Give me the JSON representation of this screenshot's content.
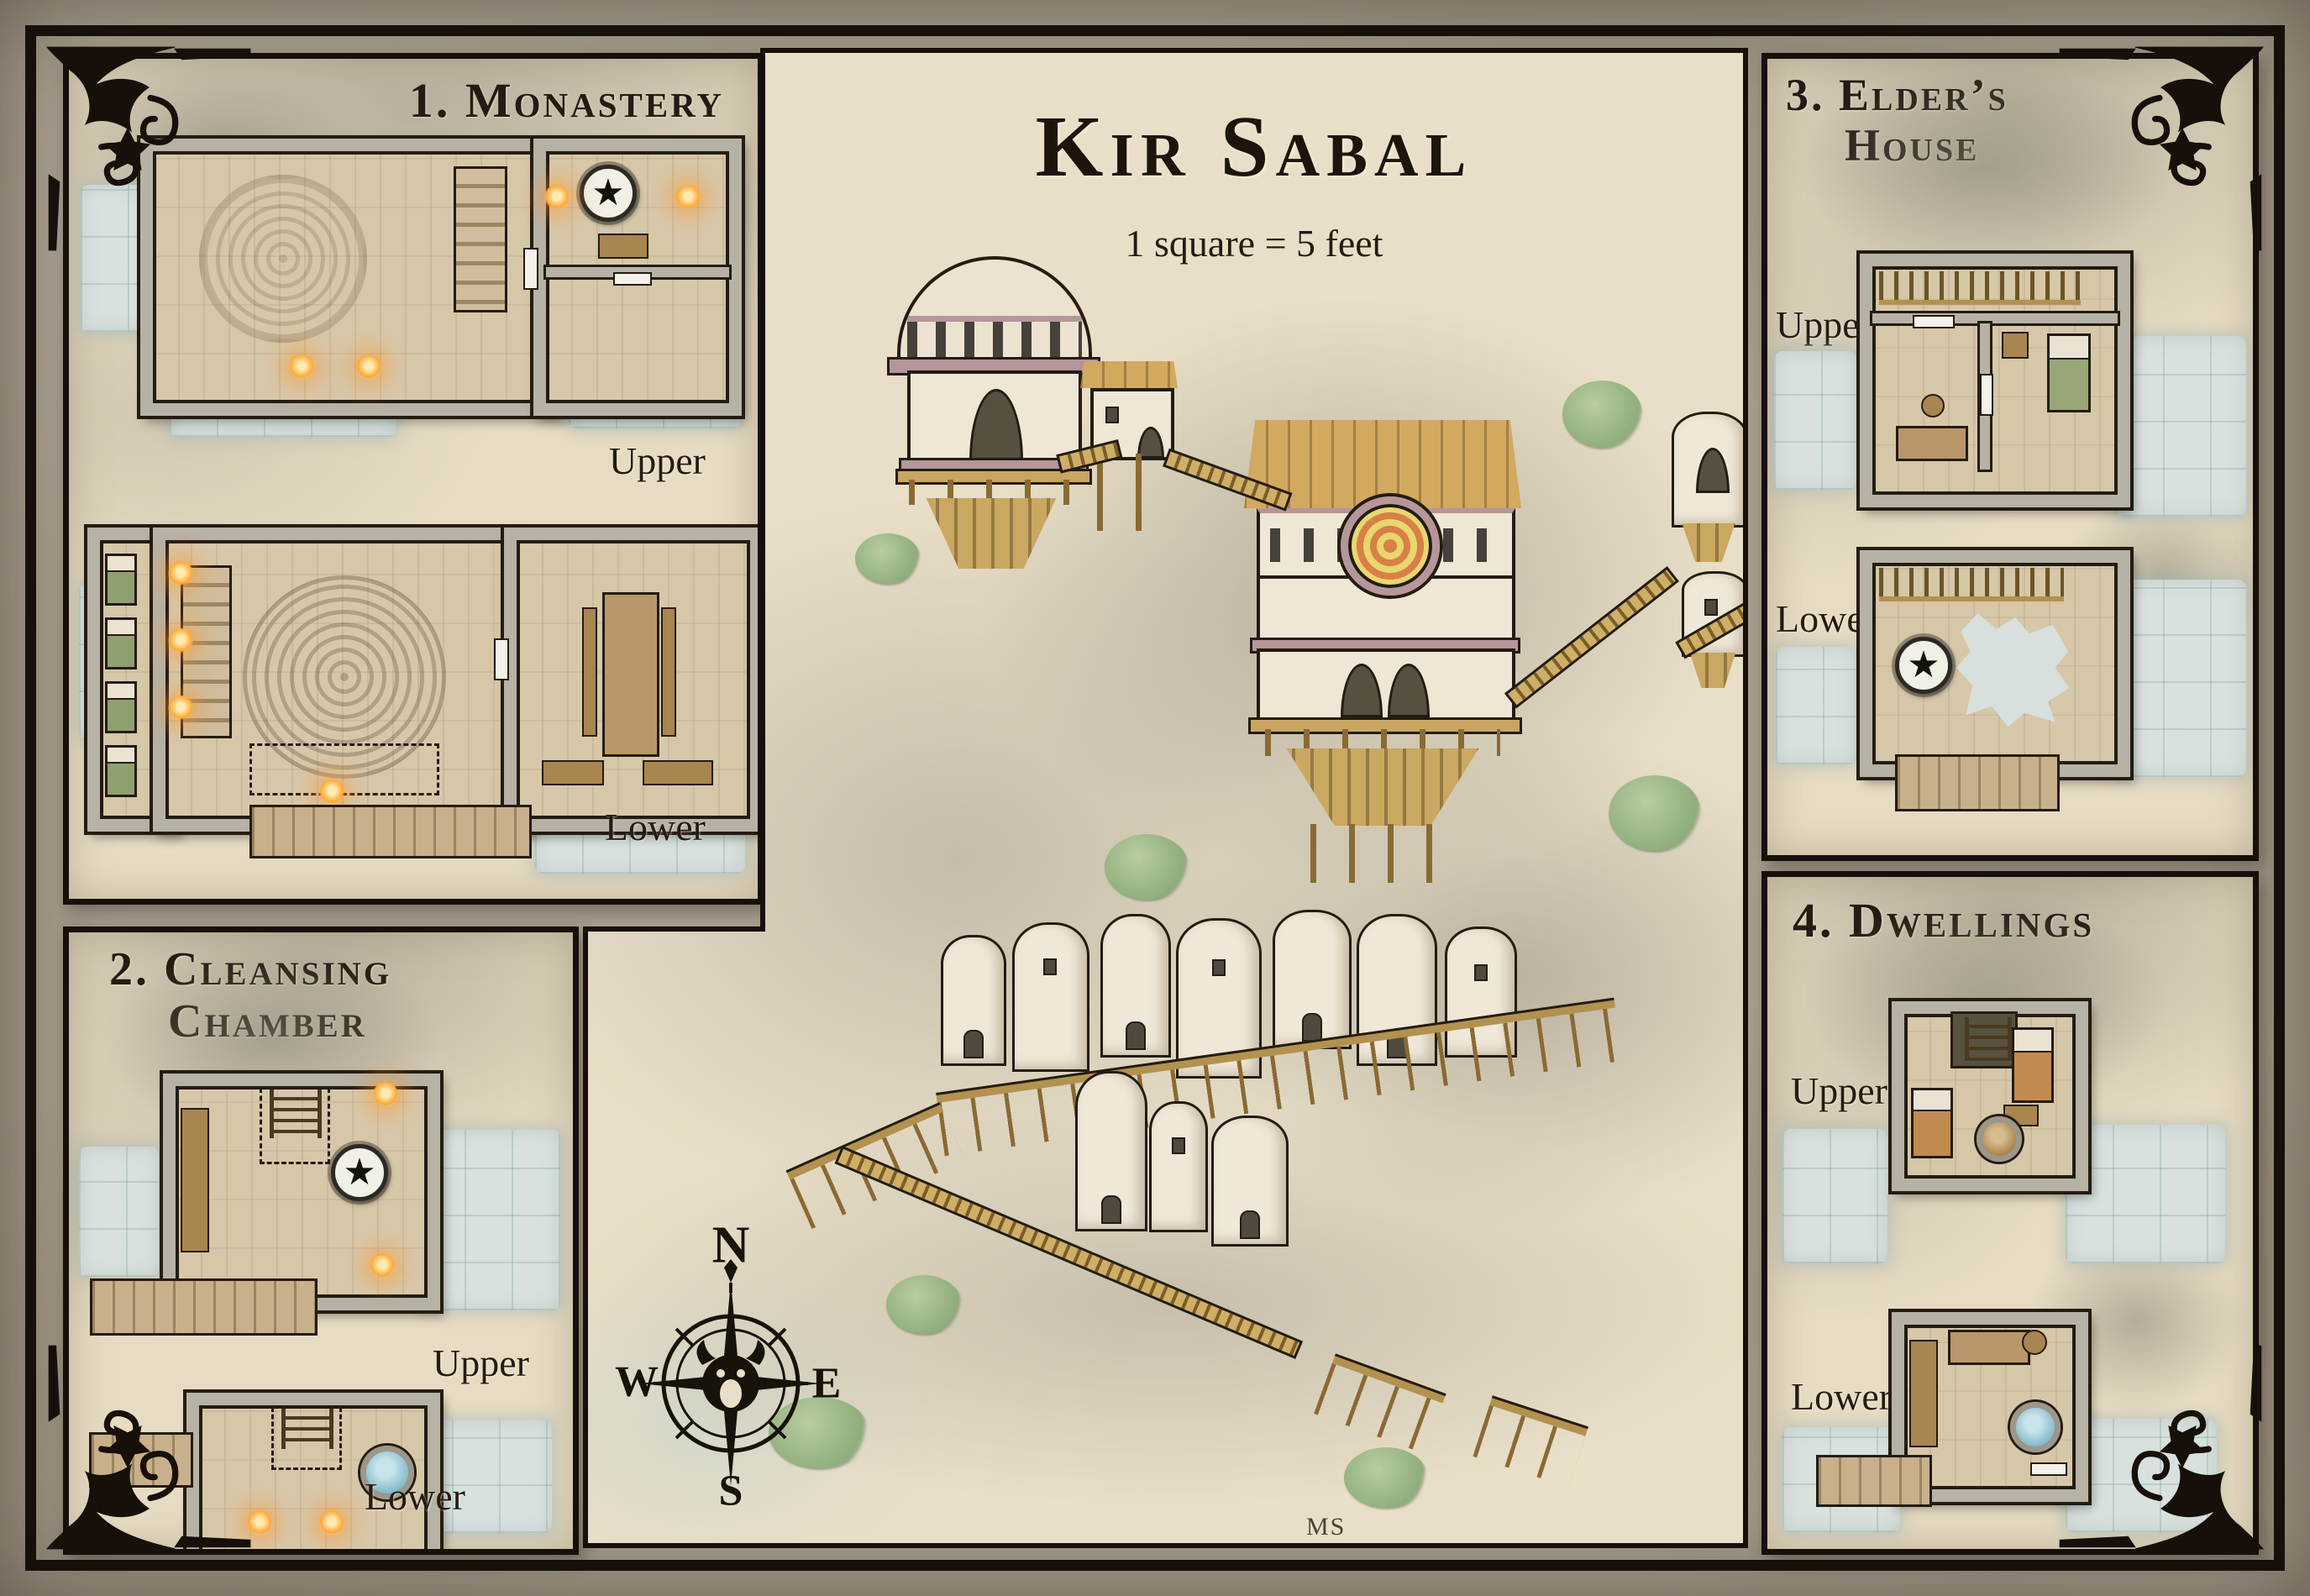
{
  "map": {
    "title": "Kir Sabal",
    "scale_note": "1 square = 5 feet",
    "signature": "MS"
  },
  "compass": {
    "north": "N",
    "east": "E",
    "south": "S",
    "west": "W"
  },
  "icons": {
    "star": "★"
  },
  "panels": [
    {
      "number": "1",
      "title": "1. Monastery",
      "title_lines": [
        "1. Monastery"
      ],
      "floors": [
        {
          "label": "Upper"
        },
        {
          "label": "Lower"
        }
      ]
    },
    {
      "number": "2",
      "title": "2. Cleansing Chamber",
      "title_lines": [
        "2. Cleansing",
        "Chamber"
      ],
      "floors": [
        {
          "label": "Upper"
        },
        {
          "label": "Lower"
        }
      ]
    },
    {
      "number": "3",
      "title": "3. Elder’s House",
      "title_lines": [
        "3. Elder’s",
        "House"
      ],
      "floors": [
        {
          "label": "Upper"
        },
        {
          "label": "Lower"
        }
      ]
    },
    {
      "number": "4",
      "title": "4. Dwellings",
      "title_lines": [
        "4. Dwellings"
      ],
      "floors": [
        {
          "label": "Upper"
        },
        {
          "label": "Lower"
        }
      ]
    }
  ],
  "colors": {
    "frame": "#17100a",
    "margin": "#a79e8e",
    "parchment": "#e7dcc3",
    "rock": "#a9a496",
    "floor_wood": "#d7c7a9",
    "wall_stone": "#b6b2a5",
    "grid_blue": "#d8e1dd",
    "roof_wood": "#d2a95f",
    "trim_mauve": "#b5969b",
    "torch_orange": "#f09030",
    "vegetation": "#9cb488",
    "ink": "#241c12"
  }
}
